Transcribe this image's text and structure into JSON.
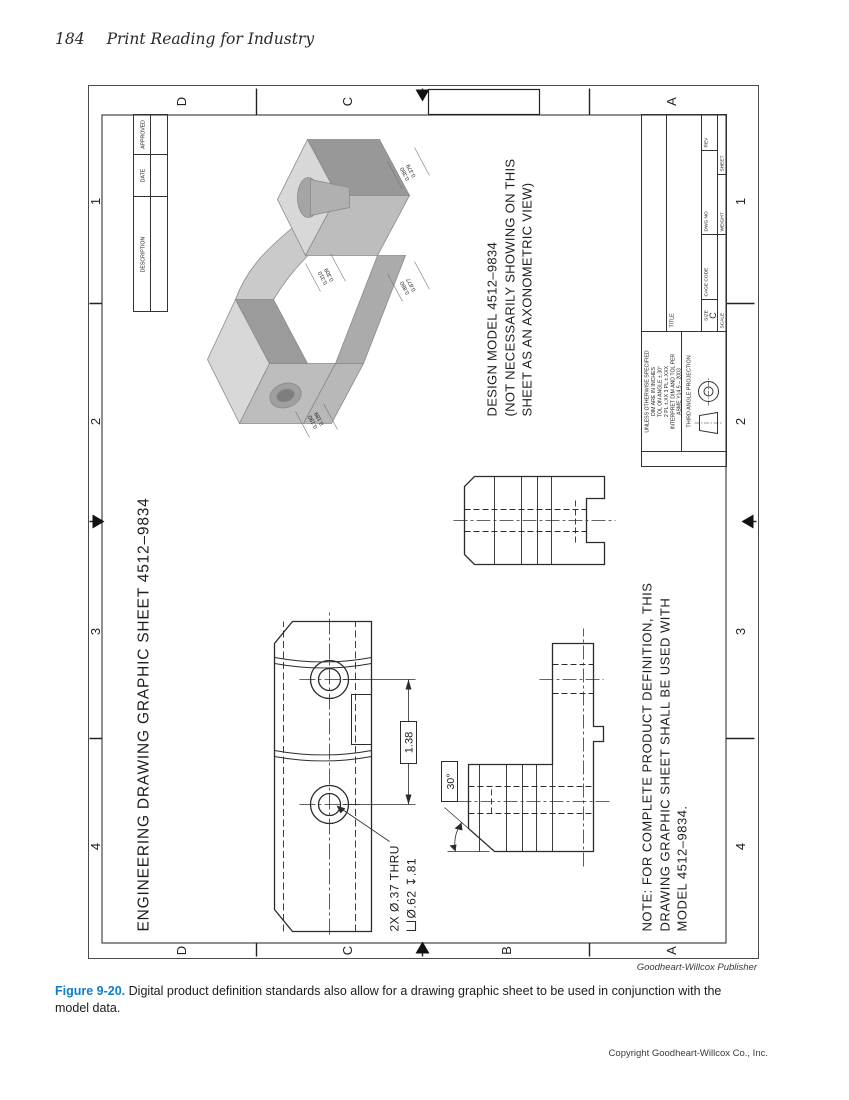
{
  "page": {
    "number": "184",
    "book_title": "Print Reading for Industry",
    "credit": "Goodheart-Willcox Publisher",
    "figure_label": "Figure 9-20.",
    "figure_caption": "Digital product definition standards also allow for a drawing graphic sheet to be used in conjunction with the model data.",
    "copyright": "Copyright Goodheart-Willcox Co., Inc.",
    "accent_color": "#0d7ec9"
  },
  "sheet": {
    "heading": "ENGINEERING DRAWING GRAPHIC SHEET 4512–9834",
    "zones": {
      "columns": [
        "4",
        "3",
        "2",
        "1"
      ],
      "rows": [
        "D",
        "C",
        "B",
        "A"
      ]
    },
    "revision_table": {
      "headers": [
        "DESCRIPTION",
        "DATE",
        "APPROVED"
      ]
    },
    "design_model_note": {
      "line1": "DESIGN MODEL 4512–9834",
      "line2": "(NOT NECESSARILY SHOWING ON THIS",
      "line3": "SHEET AS AN AXONOMETRIC VIEW)"
    },
    "general_note": {
      "line1": "NOTE: FOR COMPLETE PRODUCT DEFINITION, THIS",
      "line2": "DRAWING GRAPHIC SHEET SHALL BE USED WITH",
      "line3": "MODEL 4512–9834."
    },
    "dimensions": {
      "hole_spacing": "1.38",
      "hole_note_line1": "2X Ø.37 THRU",
      "counterbore_symbol": "⌴",
      "hole_note_line2": "Ø.62 ↧.81",
      "chamfer_angle": "30°",
      "model_dims": [
        {
          "upper": "0.310",
          "lower": "0.309"
        },
        {
          "upper": "0.880",
          "lower": "0.877"
        },
        {
          "upper": "0.190",
          "lower": "0.189"
        },
        {
          "upper": "0.380",
          "lower": "0.379"
        }
      ]
    },
    "title_block": {
      "tolerance_lines": [
        "UNLESS OTHERWISE SPECIFIED",
        "DIM ARE IN INCHES",
        "TOL ON ANGLE ±.30°",
        "2 PL ±.XX 3 PL ±.XXX",
        "INTERPRET DIM AND TOL PER",
        "ASME Y14.5 – 2003"
      ],
      "projection_label": "THIRD ANGLE PROJECTION",
      "labels": {
        "title": "TITLE",
        "size": "SIZE",
        "cage_code": "CAGE CODE",
        "dwg_no": "DWG NO",
        "rev": "REV",
        "scale": "SCALE",
        "weight": "WEIGHT",
        "sheet": "SHEET"
      },
      "size_value": "C"
    }
  }
}
